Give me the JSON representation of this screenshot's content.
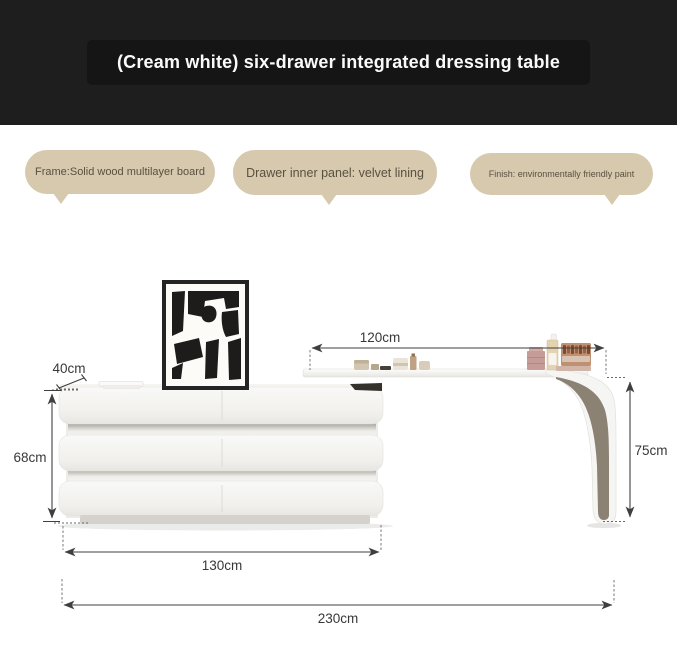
{
  "header": {
    "title": "(Cream white) six-drawer integrated dressing table"
  },
  "callouts": {
    "frame": "Frame:Solid wood multilayer board",
    "drawer": "Drawer inner panel: velvet lining",
    "finish": "Finish: environmentally friendly paint"
  },
  "dimensions": {
    "top_depth": "40cm",
    "tabletop_length": "120cm",
    "cabinet_height": "68cm",
    "table_height": "75cm",
    "cabinet_length": "130cm",
    "overall_length": "230cm"
  },
  "colors": {
    "header_bg": "#1e1e1e",
    "bubble_bg": "#d6c9ae",
    "bubble_text": "#5a5040",
    "cabinet_white": "#f4f3f0",
    "leg_inner_face": "#8b8274",
    "dimension_line": "#3f3f3f",
    "art_black": "#1d1c1a"
  }
}
